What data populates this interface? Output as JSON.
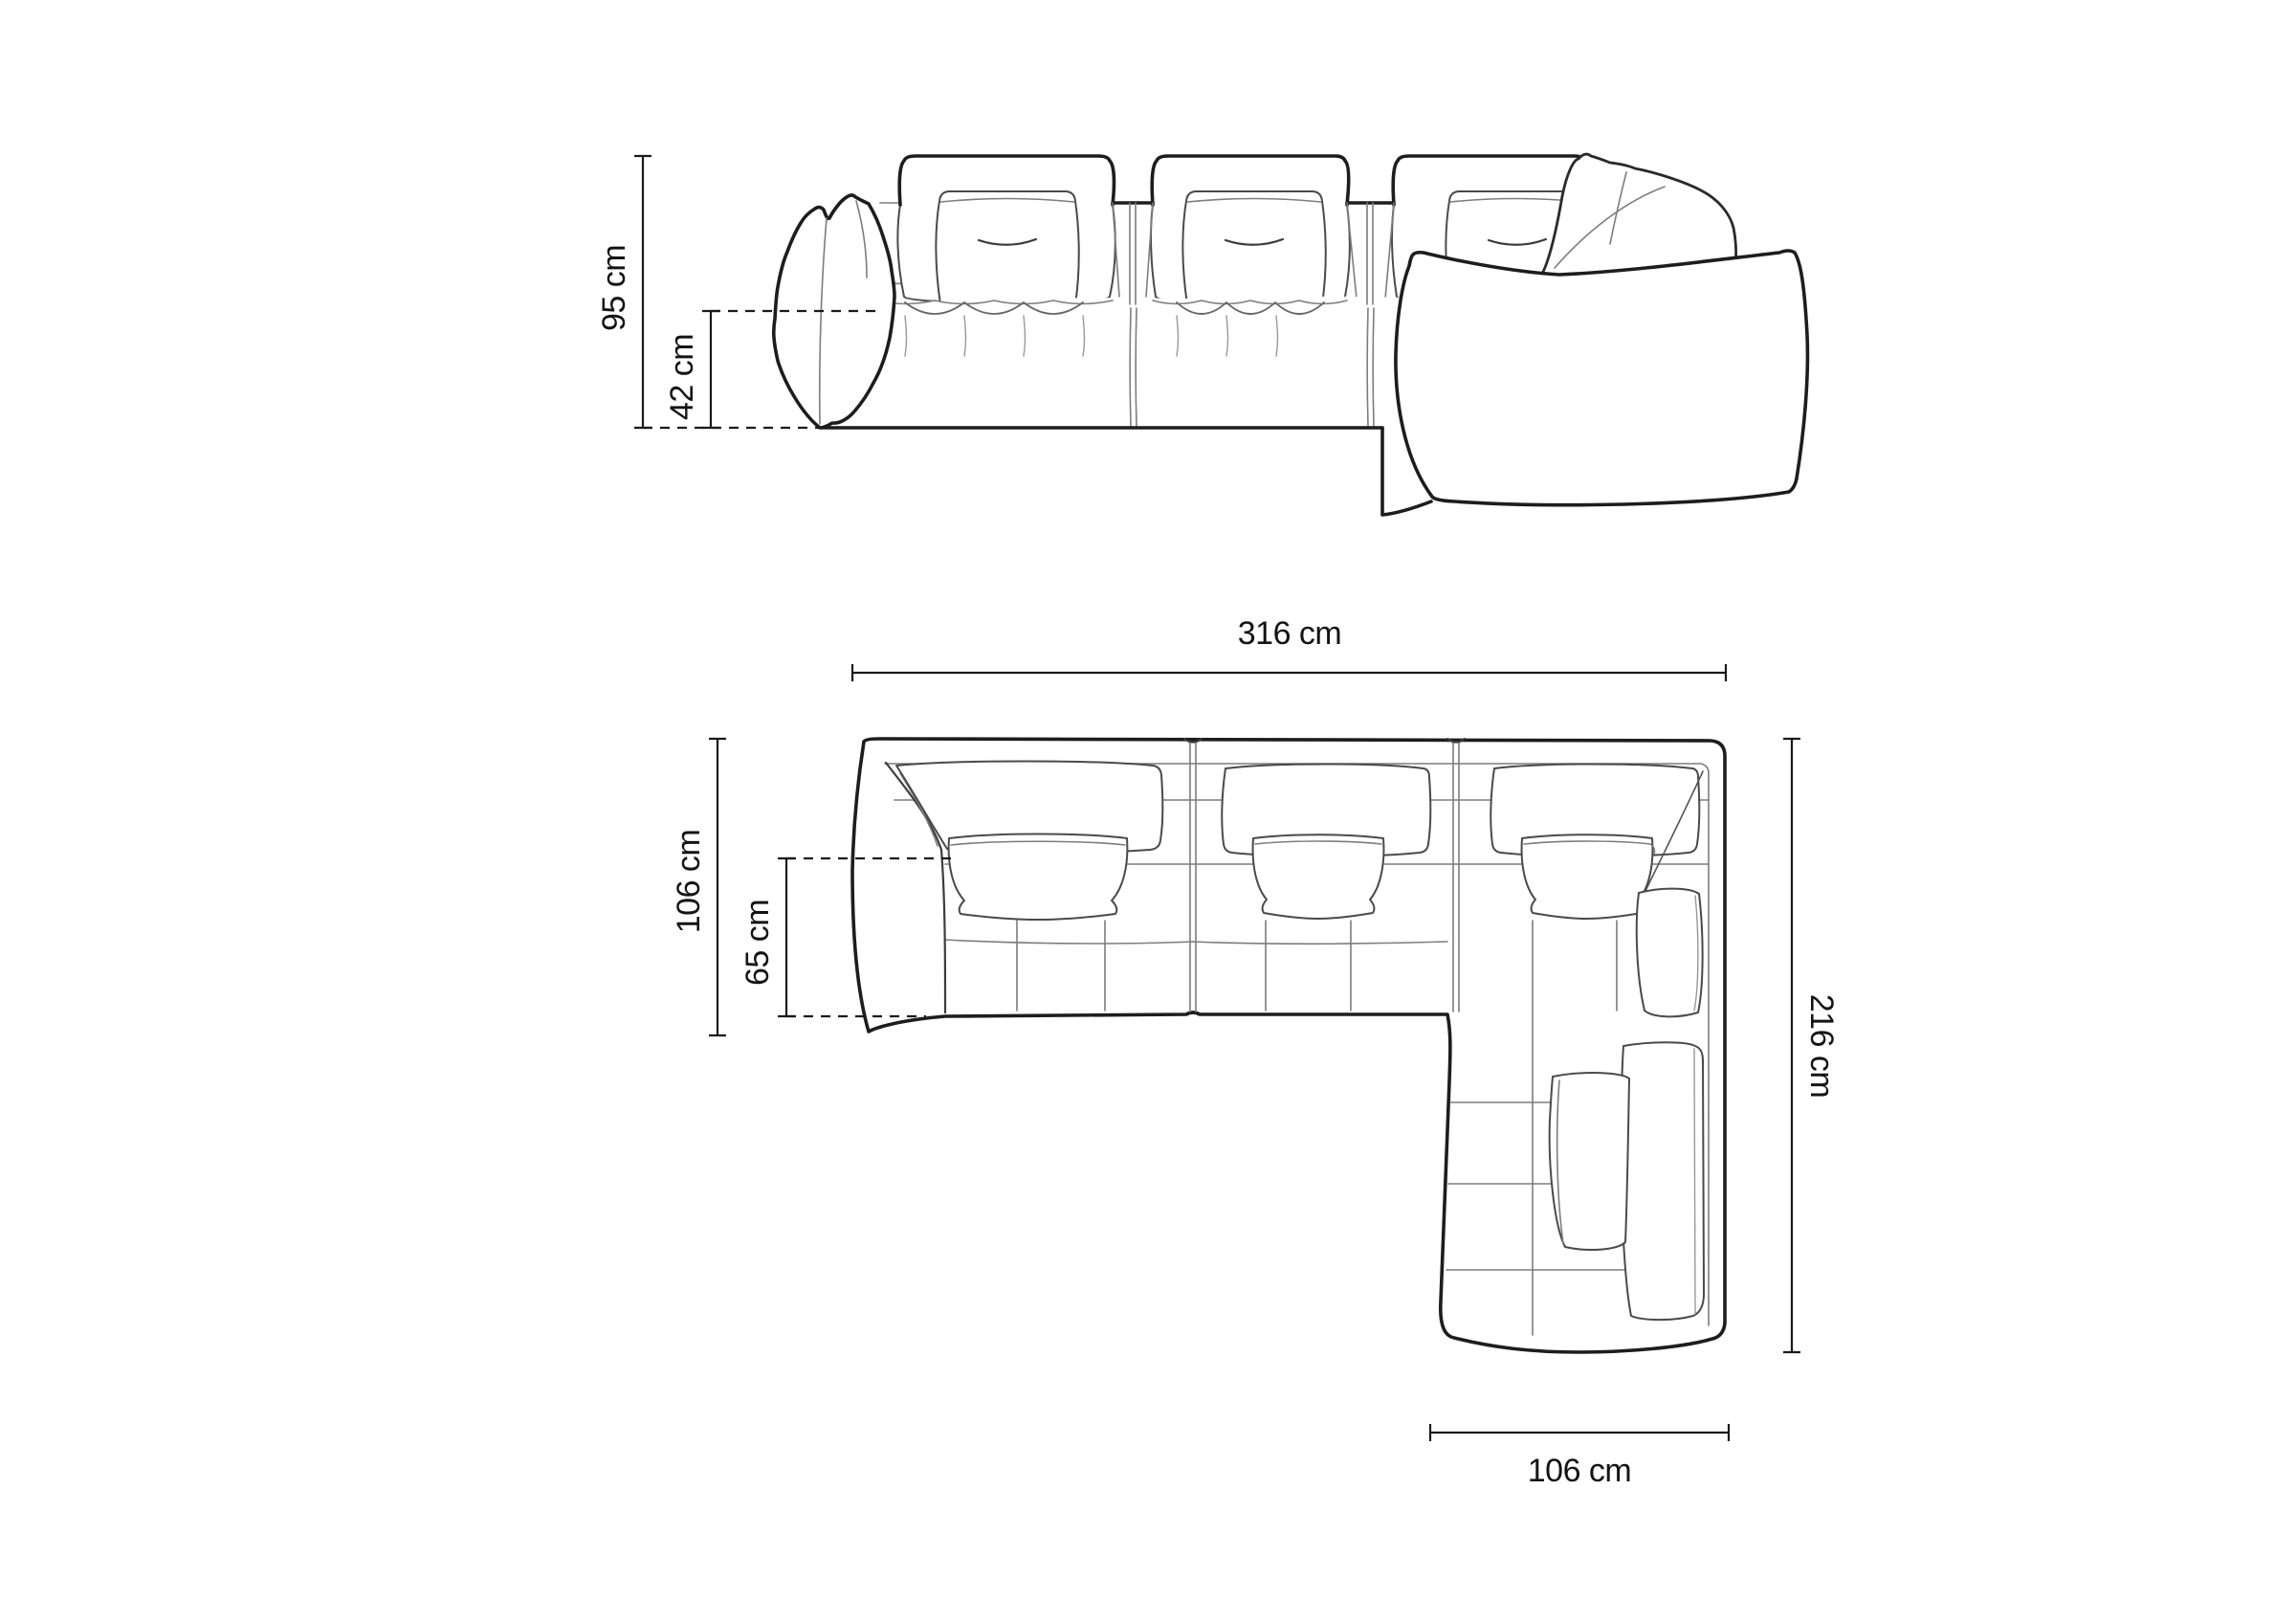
{
  "diagram": {
    "type": "sofa-dimension-drawing",
    "background": "#ffffff",
    "line_color": "#1d1d1d",
    "detail_line_color": "#7d7d7d",
    "front_view": {
      "total_height": "95 cm",
      "seat_height": "42 cm"
    },
    "top_view": {
      "total_width": "316 cm",
      "total_depth": "106 cm",
      "seat_depth": "65 cm",
      "total_length": "216 cm",
      "chaise_width": "106 cm"
    }
  }
}
